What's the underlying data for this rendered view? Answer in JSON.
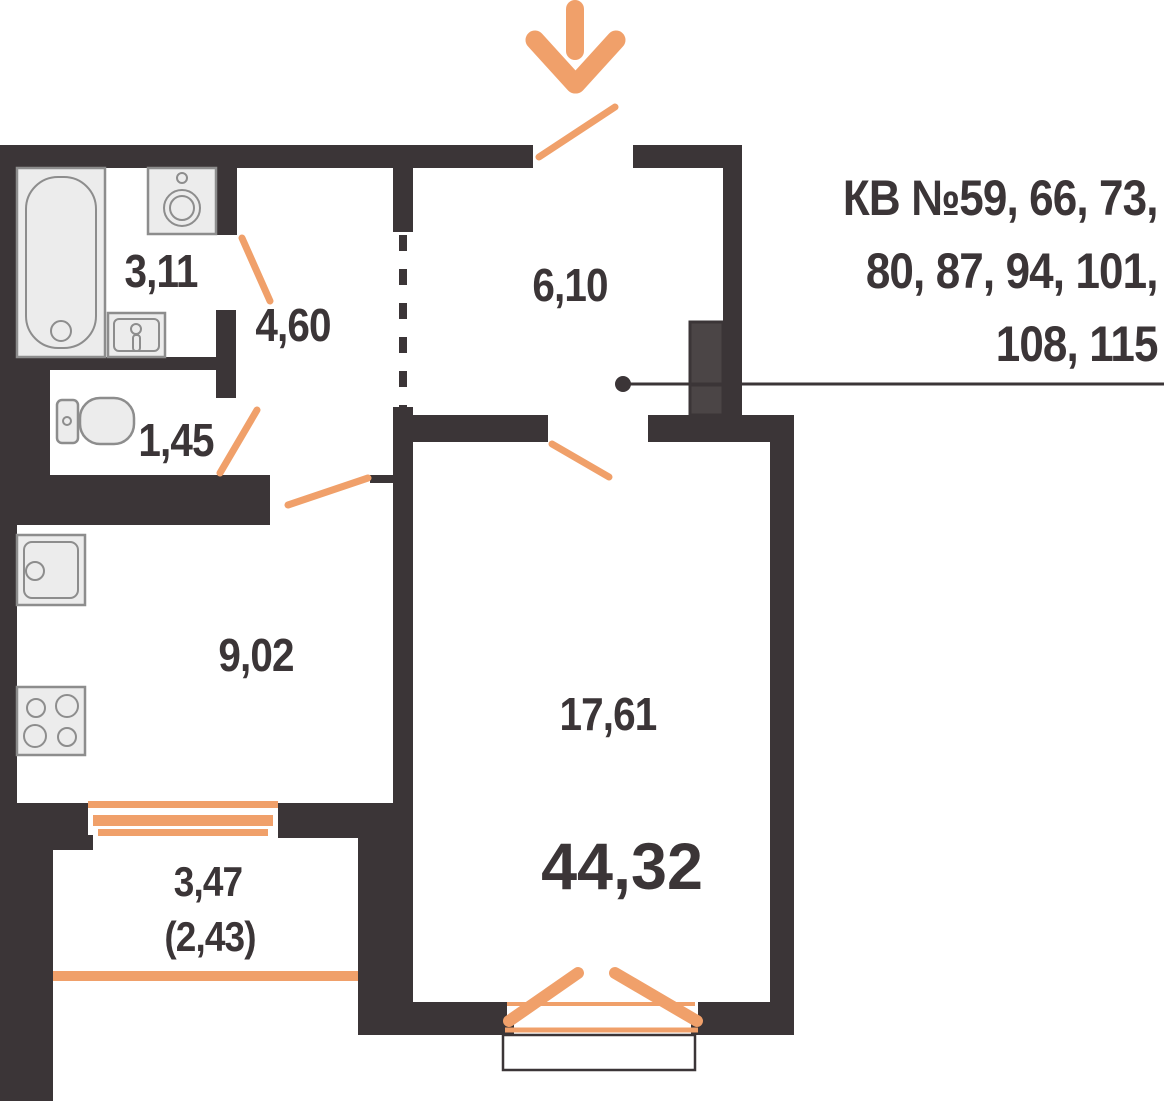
{
  "colors": {
    "wall": "#3b3537",
    "accent": "#f0a06a",
    "duct_fill": "#4b4546",
    "fixture_fill": "#ececec",
    "fixture_stroke": "#8d8d8d"
  },
  "apartment_numbers": {
    "line1": "КВ №59, 66, 73,",
    "line2": "80, 87, 94, 101,",
    "line3": "108, 115"
  },
  "rooms": {
    "bathroom": "3,11",
    "hallway": "4,60",
    "entrance_hall": "6,10",
    "wc": "1,45",
    "kitchen": "9,02",
    "living_room": "17,61",
    "balcony": "3,47",
    "balcony_reduced": "(2,43)",
    "total_area": "44,32"
  }
}
